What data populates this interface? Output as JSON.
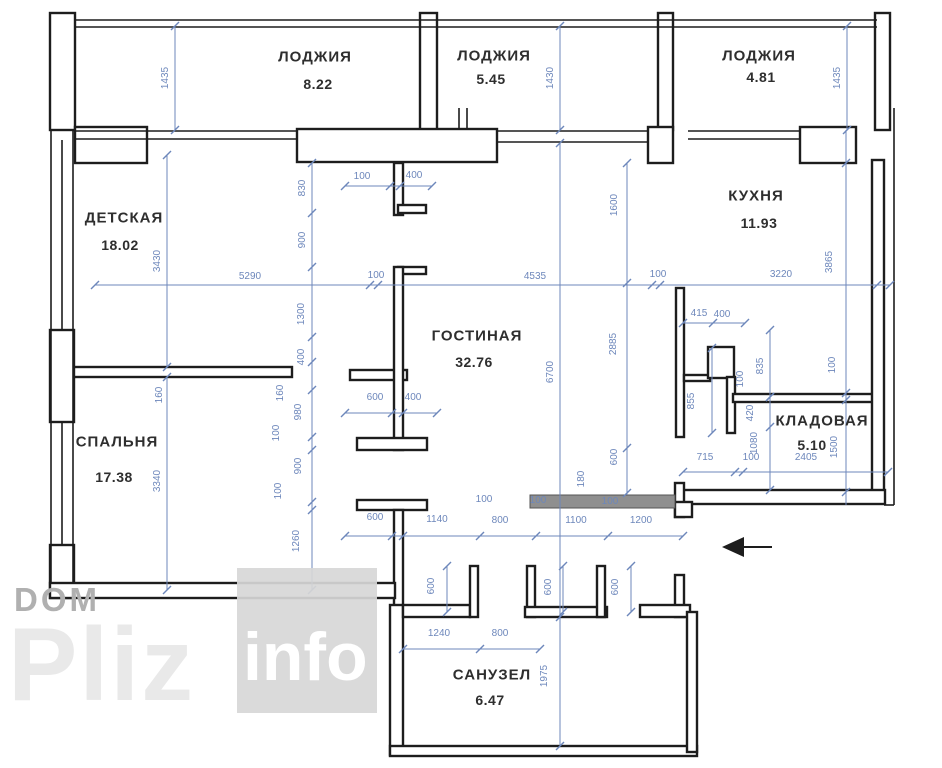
{
  "title": "apartment-floor-plan",
  "colors": {
    "wall": "#1d1d1d",
    "dimension": "#6d87bb",
    "room_text": "#2e2e2e",
    "shaded_wall": "#8f8f8f",
    "watermark_dark": "#b0b0b0",
    "watermark_light": "#e9e9e9",
    "watermark_box": "#d7d7d7"
  },
  "watermark": {
    "dom": "DOM",
    "pliz": "Pliz",
    "info": "info"
  },
  "icons": {
    "entrance_arrow": "left-arrow"
  },
  "rooms": [
    {
      "id": "loggia-1",
      "name": "ЛОДЖИЯ",
      "area": "8.22",
      "nx": 315,
      "ny": 57,
      "ax": 318,
      "ay": 84
    },
    {
      "id": "loggia-2",
      "name": "ЛОДЖИЯ",
      "area": "5.45",
      "nx": 494,
      "ny": 56,
      "ax": 491,
      "ay": 79
    },
    {
      "id": "loggia-3",
      "name": "ЛОДЖИЯ",
      "area": "4.81",
      "nx": 759,
      "ny": 56,
      "ax": 761,
      "ay": 77
    },
    {
      "id": "nursery",
      "name": "ДЕТСКАЯ",
      "area": "18.02",
      "nx": 124,
      "ny": 218,
      "ax": 120,
      "ay": 245
    },
    {
      "id": "kitchen",
      "name": "КУХНЯ",
      "area": "11.93",
      "nx": 756,
      "ny": 196,
      "ax": 759,
      "ay": 223
    },
    {
      "id": "living",
      "name": "ГОСТИНАЯ",
      "area": "32.76",
      "nx": 477,
      "ny": 336,
      "ax": 474,
      "ay": 362
    },
    {
      "id": "bedroom",
      "name": "СПАЛЬНЯ",
      "area": "17.38",
      "nx": 117,
      "ny": 442,
      "ax": 114,
      "ay": 477
    },
    {
      "id": "storage",
      "name": "КЛАДОВАЯ",
      "area": "5.10",
      "nx": 822,
      "ny": 421,
      "ax": 812,
      "ay": 445
    },
    {
      "id": "bathroom",
      "name": "САНУЗЕЛ",
      "area": "6.47",
      "nx": 492,
      "ny": 675,
      "ax": 490,
      "ay": 700
    }
  ],
  "dimensions": [
    {
      "v": "1435",
      "x": 166,
      "y": 78,
      "o": "v"
    },
    {
      "v": "1430",
      "x": 551,
      "y": 78,
      "o": "v"
    },
    {
      "v": "1435",
      "x": 838,
      "y": 78,
      "o": "v"
    },
    {
      "v": "100",
      "x": 362,
      "y": 177,
      "o": "h"
    },
    {
      "v": "400",
      "x": 414,
      "y": 176,
      "o": "h"
    },
    {
      "v": "830",
      "x": 303,
      "y": 188,
      "o": "v"
    },
    {
      "v": "900",
      "x": 303,
      "y": 240,
      "o": "v"
    },
    {
      "v": "1600",
      "x": 615,
      "y": 205,
      "o": "v"
    },
    {
      "v": "3430",
      "x": 158,
      "y": 261,
      "o": "v"
    },
    {
      "v": "3865",
      "x": 830,
      "y": 262,
      "o": "v"
    },
    {
      "v": "5290",
      "x": 250,
      "y": 277,
      "o": "h"
    },
    {
      "v": "100",
      "x": 376,
      "y": 276,
      "o": "h"
    },
    {
      "v": "4535",
      "x": 535,
      "y": 277,
      "o": "h"
    },
    {
      "v": "100",
      "x": 658,
      "y": 275,
      "o": "h"
    },
    {
      "v": "3220",
      "x": 781,
      "y": 275,
      "o": "h"
    },
    {
      "v": "1300",
      "x": 302,
      "y": 314,
      "o": "v"
    },
    {
      "v": "415",
      "x": 699,
      "y": 314,
      "o": "h"
    },
    {
      "v": "400",
      "x": 722,
      "y": 315,
      "o": "h"
    },
    {
      "v": "2885",
      "x": 614,
      "y": 344,
      "o": "v"
    },
    {
      "v": "400",
      "x": 302,
      "y": 357,
      "o": "v"
    },
    {
      "v": "6700",
      "x": 551,
      "y": 372,
      "o": "v"
    },
    {
      "v": "835",
      "x": 761,
      "y": 366,
      "o": "v"
    },
    {
      "v": "100",
      "x": 741,
      "y": 379,
      "o": "v"
    },
    {
      "v": "100",
      "x": 833,
      "y": 365,
      "o": "v"
    },
    {
      "v": "160",
      "x": 160,
      "y": 395,
      "o": "v"
    },
    {
      "v": "160",
      "x": 281,
      "y": 393,
      "o": "v"
    },
    {
      "v": "600",
      "x": 375,
      "y": 398,
      "o": "h"
    },
    {
      "v": "400",
      "x": 413,
      "y": 398,
      "o": "h"
    },
    {
      "v": "855",
      "x": 692,
      "y": 401,
      "o": "v"
    },
    {
      "v": "980",
      "x": 299,
      "y": 412,
      "o": "v"
    },
    {
      "v": "420",
      "x": 751,
      "y": 413,
      "o": "v"
    },
    {
      "v": "100",
      "x": 277,
      "y": 433,
      "o": "v"
    },
    {
      "v": "1080",
      "x": 755,
      "y": 443,
      "o": "v"
    },
    {
      "v": "1500",
      "x": 835,
      "y": 447,
      "o": "v"
    },
    {
      "v": "900",
      "x": 299,
      "y": 466,
      "o": "v"
    },
    {
      "v": "715",
      "x": 705,
      "y": 458,
      "o": "h"
    },
    {
      "v": "100",
      "x": 751,
      "y": 458,
      "o": "h"
    },
    {
      "v": "2405",
      "x": 806,
      "y": 458,
      "o": "h"
    },
    {
      "v": "600",
      "x": 615,
      "y": 457,
      "o": "v"
    },
    {
      "v": "180",
      "x": 582,
      "y": 479,
      "o": "v"
    },
    {
      "v": "100",
      "x": 279,
      "y": 491,
      "o": "v"
    },
    {
      "v": "3340",
      "x": 158,
      "y": 481,
      "o": "v"
    },
    {
      "v": "100",
      "x": 484,
      "y": 500,
      "o": "h"
    },
    {
      "v": "100",
      "x": 538,
      "y": 501,
      "o": "h"
    },
    {
      "v": "100",
      "x": 610,
      "y": 502,
      "o": "h"
    },
    {
      "v": "600",
      "x": 375,
      "y": 518,
      "o": "h"
    },
    {
      "v": "1140",
      "x": 437,
      "y": 520,
      "o": "h"
    },
    {
      "v": "800",
      "x": 500,
      "y": 521,
      "o": "h"
    },
    {
      "v": "1100",
      "x": 576,
      "y": 521,
      "o": "h"
    },
    {
      "v": "1200",
      "x": 641,
      "y": 521,
      "o": "h"
    },
    {
      "v": "1260",
      "x": 297,
      "y": 541,
      "o": "v"
    },
    {
      "v": "600",
      "x": 432,
      "y": 586,
      "o": "v"
    },
    {
      "v": "600",
      "x": 549,
      "y": 587,
      "o": "v"
    },
    {
      "v": "600",
      "x": 616,
      "y": 587,
      "o": "v"
    },
    {
      "v": "1240",
      "x": 439,
      "y": 634,
      "o": "h"
    },
    {
      "v": "800",
      "x": 500,
      "y": 634,
      "o": "h"
    },
    {
      "v": "1975",
      "x": 545,
      "y": 676,
      "o": "v"
    }
  ]
}
